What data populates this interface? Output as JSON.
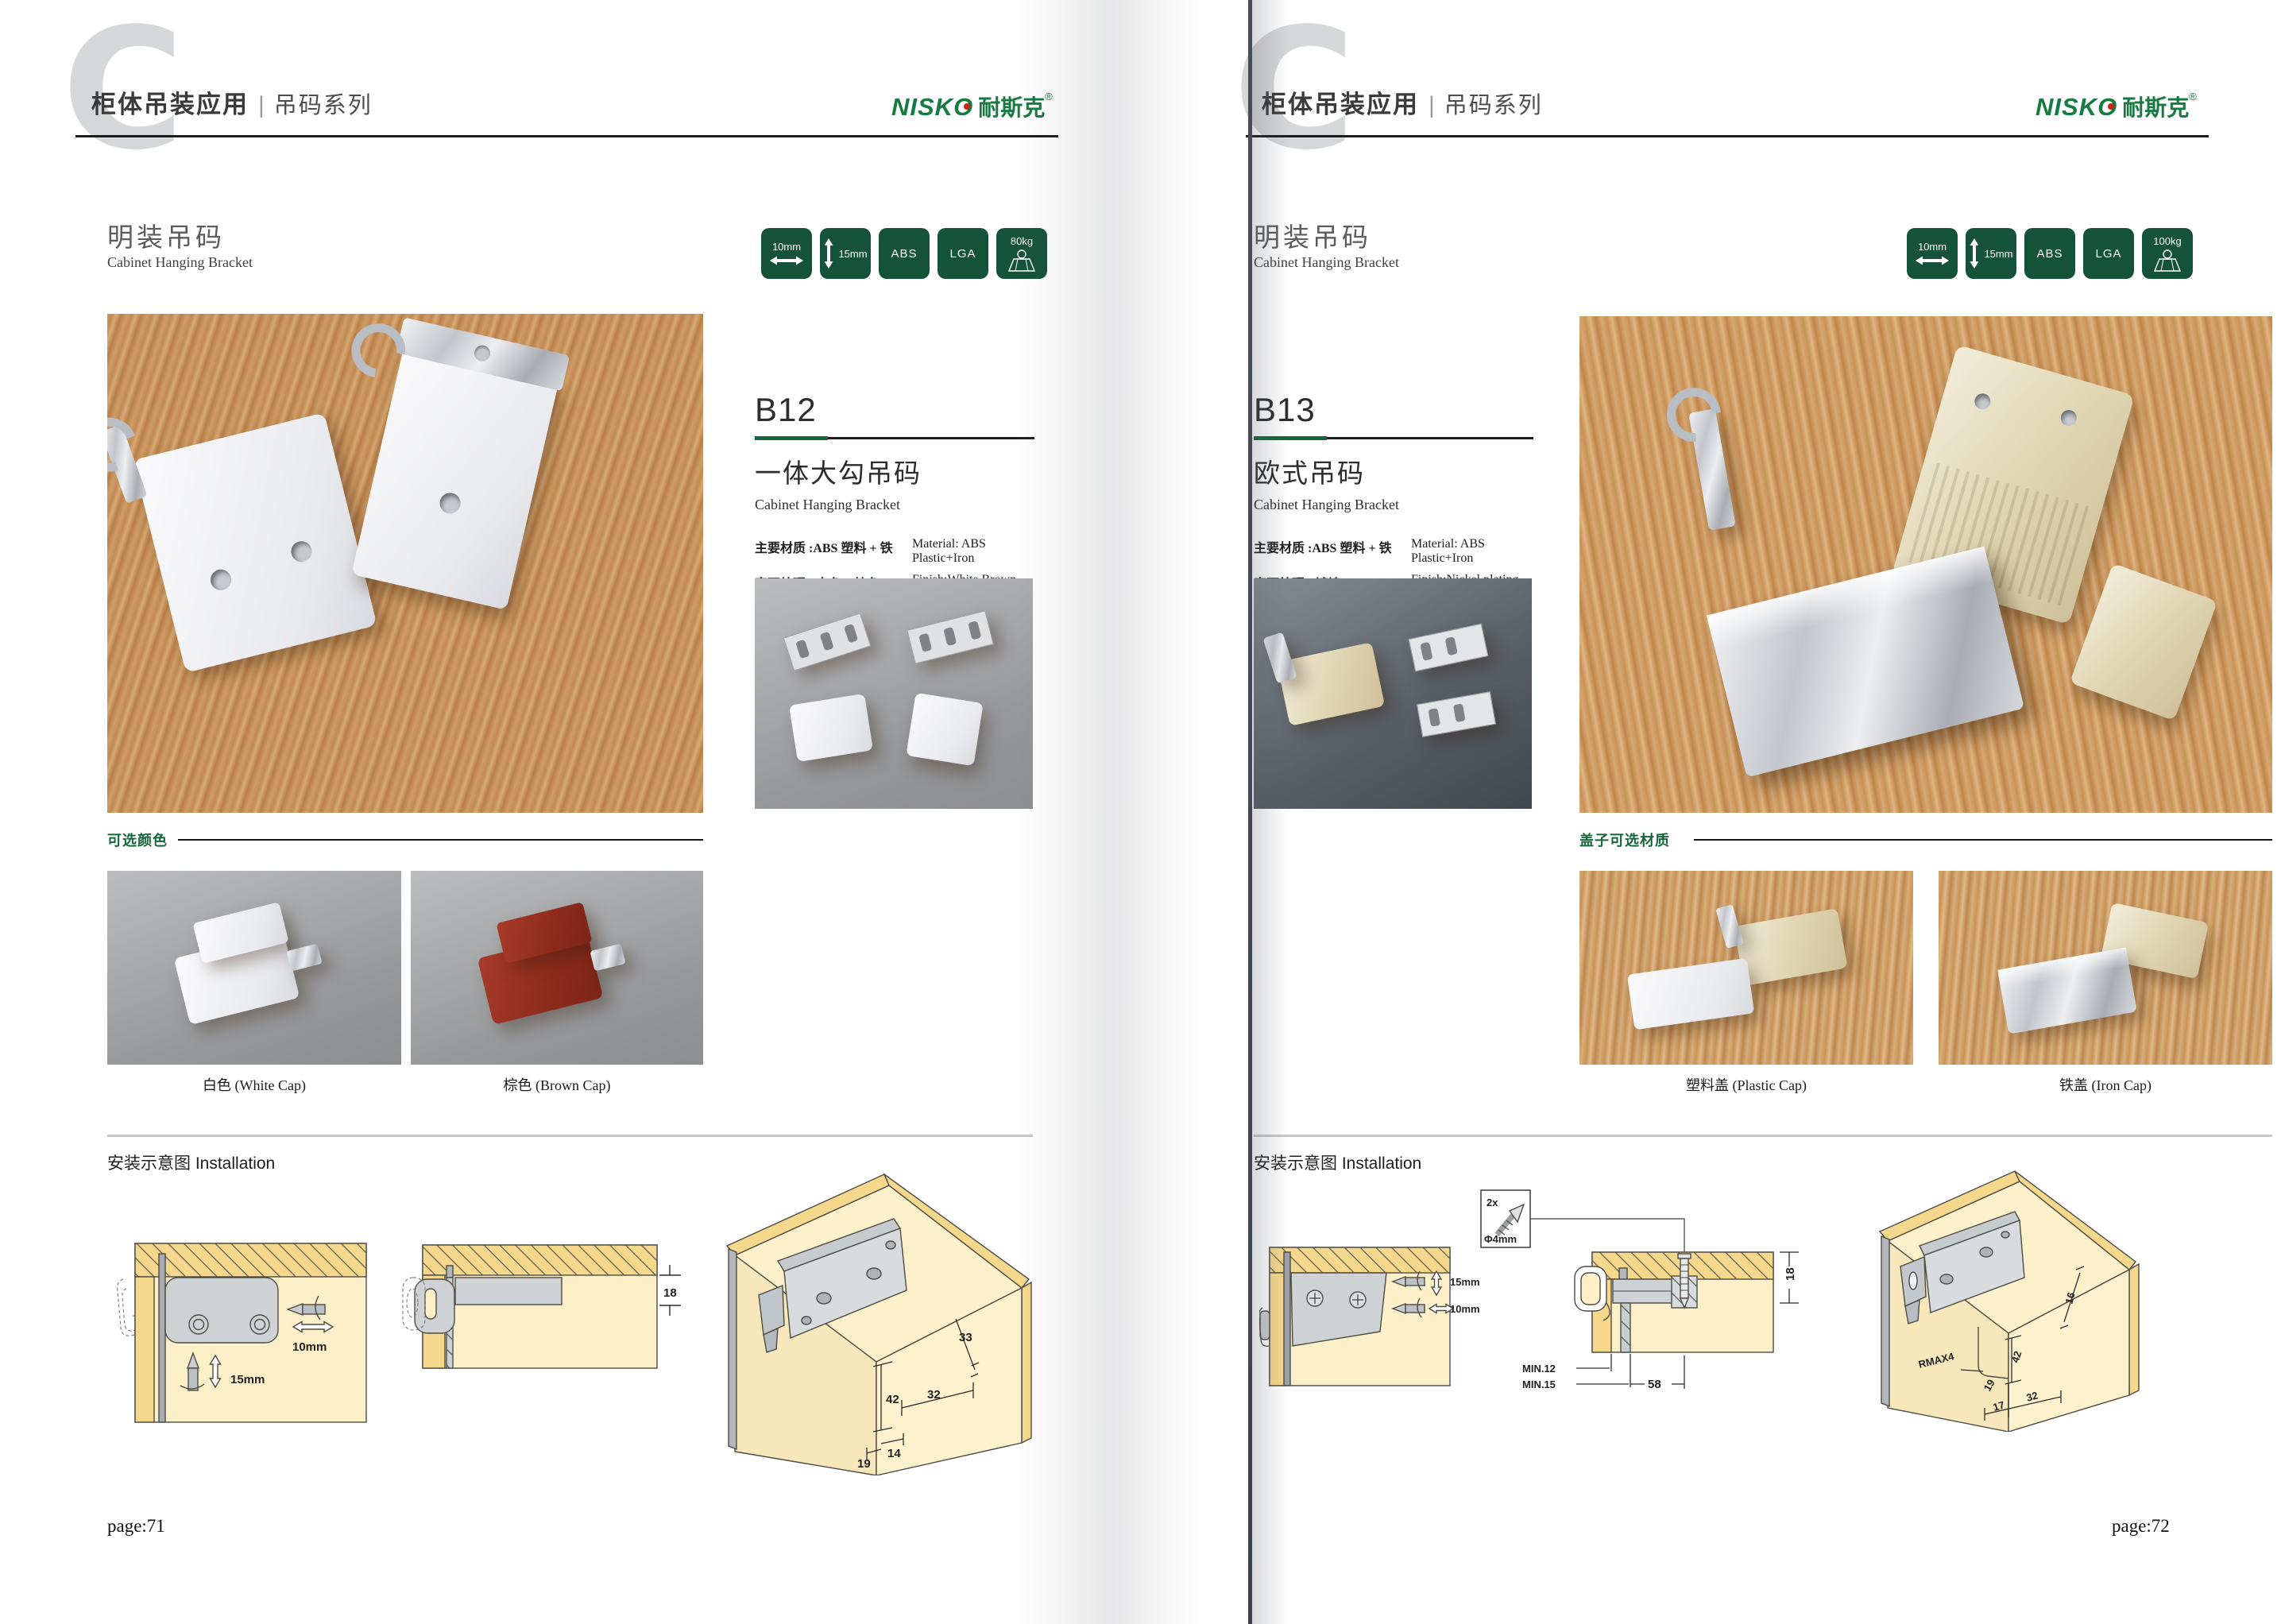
{
  "colors": {
    "brand_green": "#177a42",
    "badge_green": "#14533a",
    "accent_green": "#15663b",
    "logo_dot_red": "#cf2017"
  },
  "header": {
    "title_cn": "柜体吊装应用",
    "divider": "|",
    "series": "吊码系列"
  },
  "brand": {
    "logo": "NISKO",
    "logo_cn": "耐斯克",
    "reg": "®"
  },
  "left_page": {
    "section_cn": "明装吊码",
    "section_en": "Cabinet Hanging Bracket",
    "badges": {
      "width": "10mm",
      "height": "15mm",
      "material": "ABS",
      "cert": "LGA",
      "load": "80kg"
    },
    "product": {
      "model": "B12",
      "name_cn": "一体大勾吊码",
      "name_en": "Cabinet Hanging Bracket",
      "material_cn": "主要材质 :ABS 塑料 + 铁",
      "material_en": "Material: ABS Plastic+Iron",
      "finish_cn": "表面处理 : 白色、棕色",
      "finish_en": "Finish:White,Brown"
    },
    "options": {
      "label": "可选颜色",
      "opt1_caption": "白色 (White Cap)",
      "opt2_caption": "棕色 (Brown Cap)"
    },
    "installation": {
      "label": "安装示意图 Installation",
      "d1": {
        "dim_h": "10mm",
        "dim_v": "15mm"
      },
      "d2": {
        "dim": "18"
      },
      "d3": {
        "dim_a": "33",
        "dim_b": "42",
        "dim_c": "32",
        "dim_d": "14",
        "dim_e": "19"
      }
    },
    "footer": "page:71"
  },
  "right_page": {
    "section_cn": "明装吊码",
    "section_en": "Cabinet Hanging Bracket",
    "badges": {
      "width": "10mm",
      "height": "15mm",
      "material": "ABS",
      "cert": "LGA",
      "load": "100kg"
    },
    "product": {
      "model": "B13",
      "name_cn": "欧式吊码",
      "name_en": "Cabinet Hanging Bracket",
      "material_cn": "主要材质 :ABS 塑料 + 铁",
      "material_en": "Material: ABS Plastic+Iron",
      "finish_cn": "表面处理 : 镀镍",
      "finish_en": "Finish:Nickel plating"
    },
    "options": {
      "label": "盖子可选材质",
      "opt1_caption": "塑料盖 (Plastic Cap)",
      "opt2_caption": "铁盖 (Iron Cap)"
    },
    "installation": {
      "label": "安装示意图 Installation",
      "screw_box": {
        "qty": "2x",
        "dia": "Φ4mm"
      },
      "d1": {
        "dim_v": "15mm",
        "dim_h": "10mm"
      },
      "d2": {
        "dim_side": "18",
        "min1": "MIN.12",
        "min2": "MIN.15",
        "dim_bottom": "58"
      },
      "d3": {
        "dim_a": "16",
        "dim_b": "42",
        "dim_c": "RMAX4",
        "dim_d": "19",
        "dim_e": "17",
        "dim_f": "32"
      }
    },
    "footer": "page:72"
  }
}
